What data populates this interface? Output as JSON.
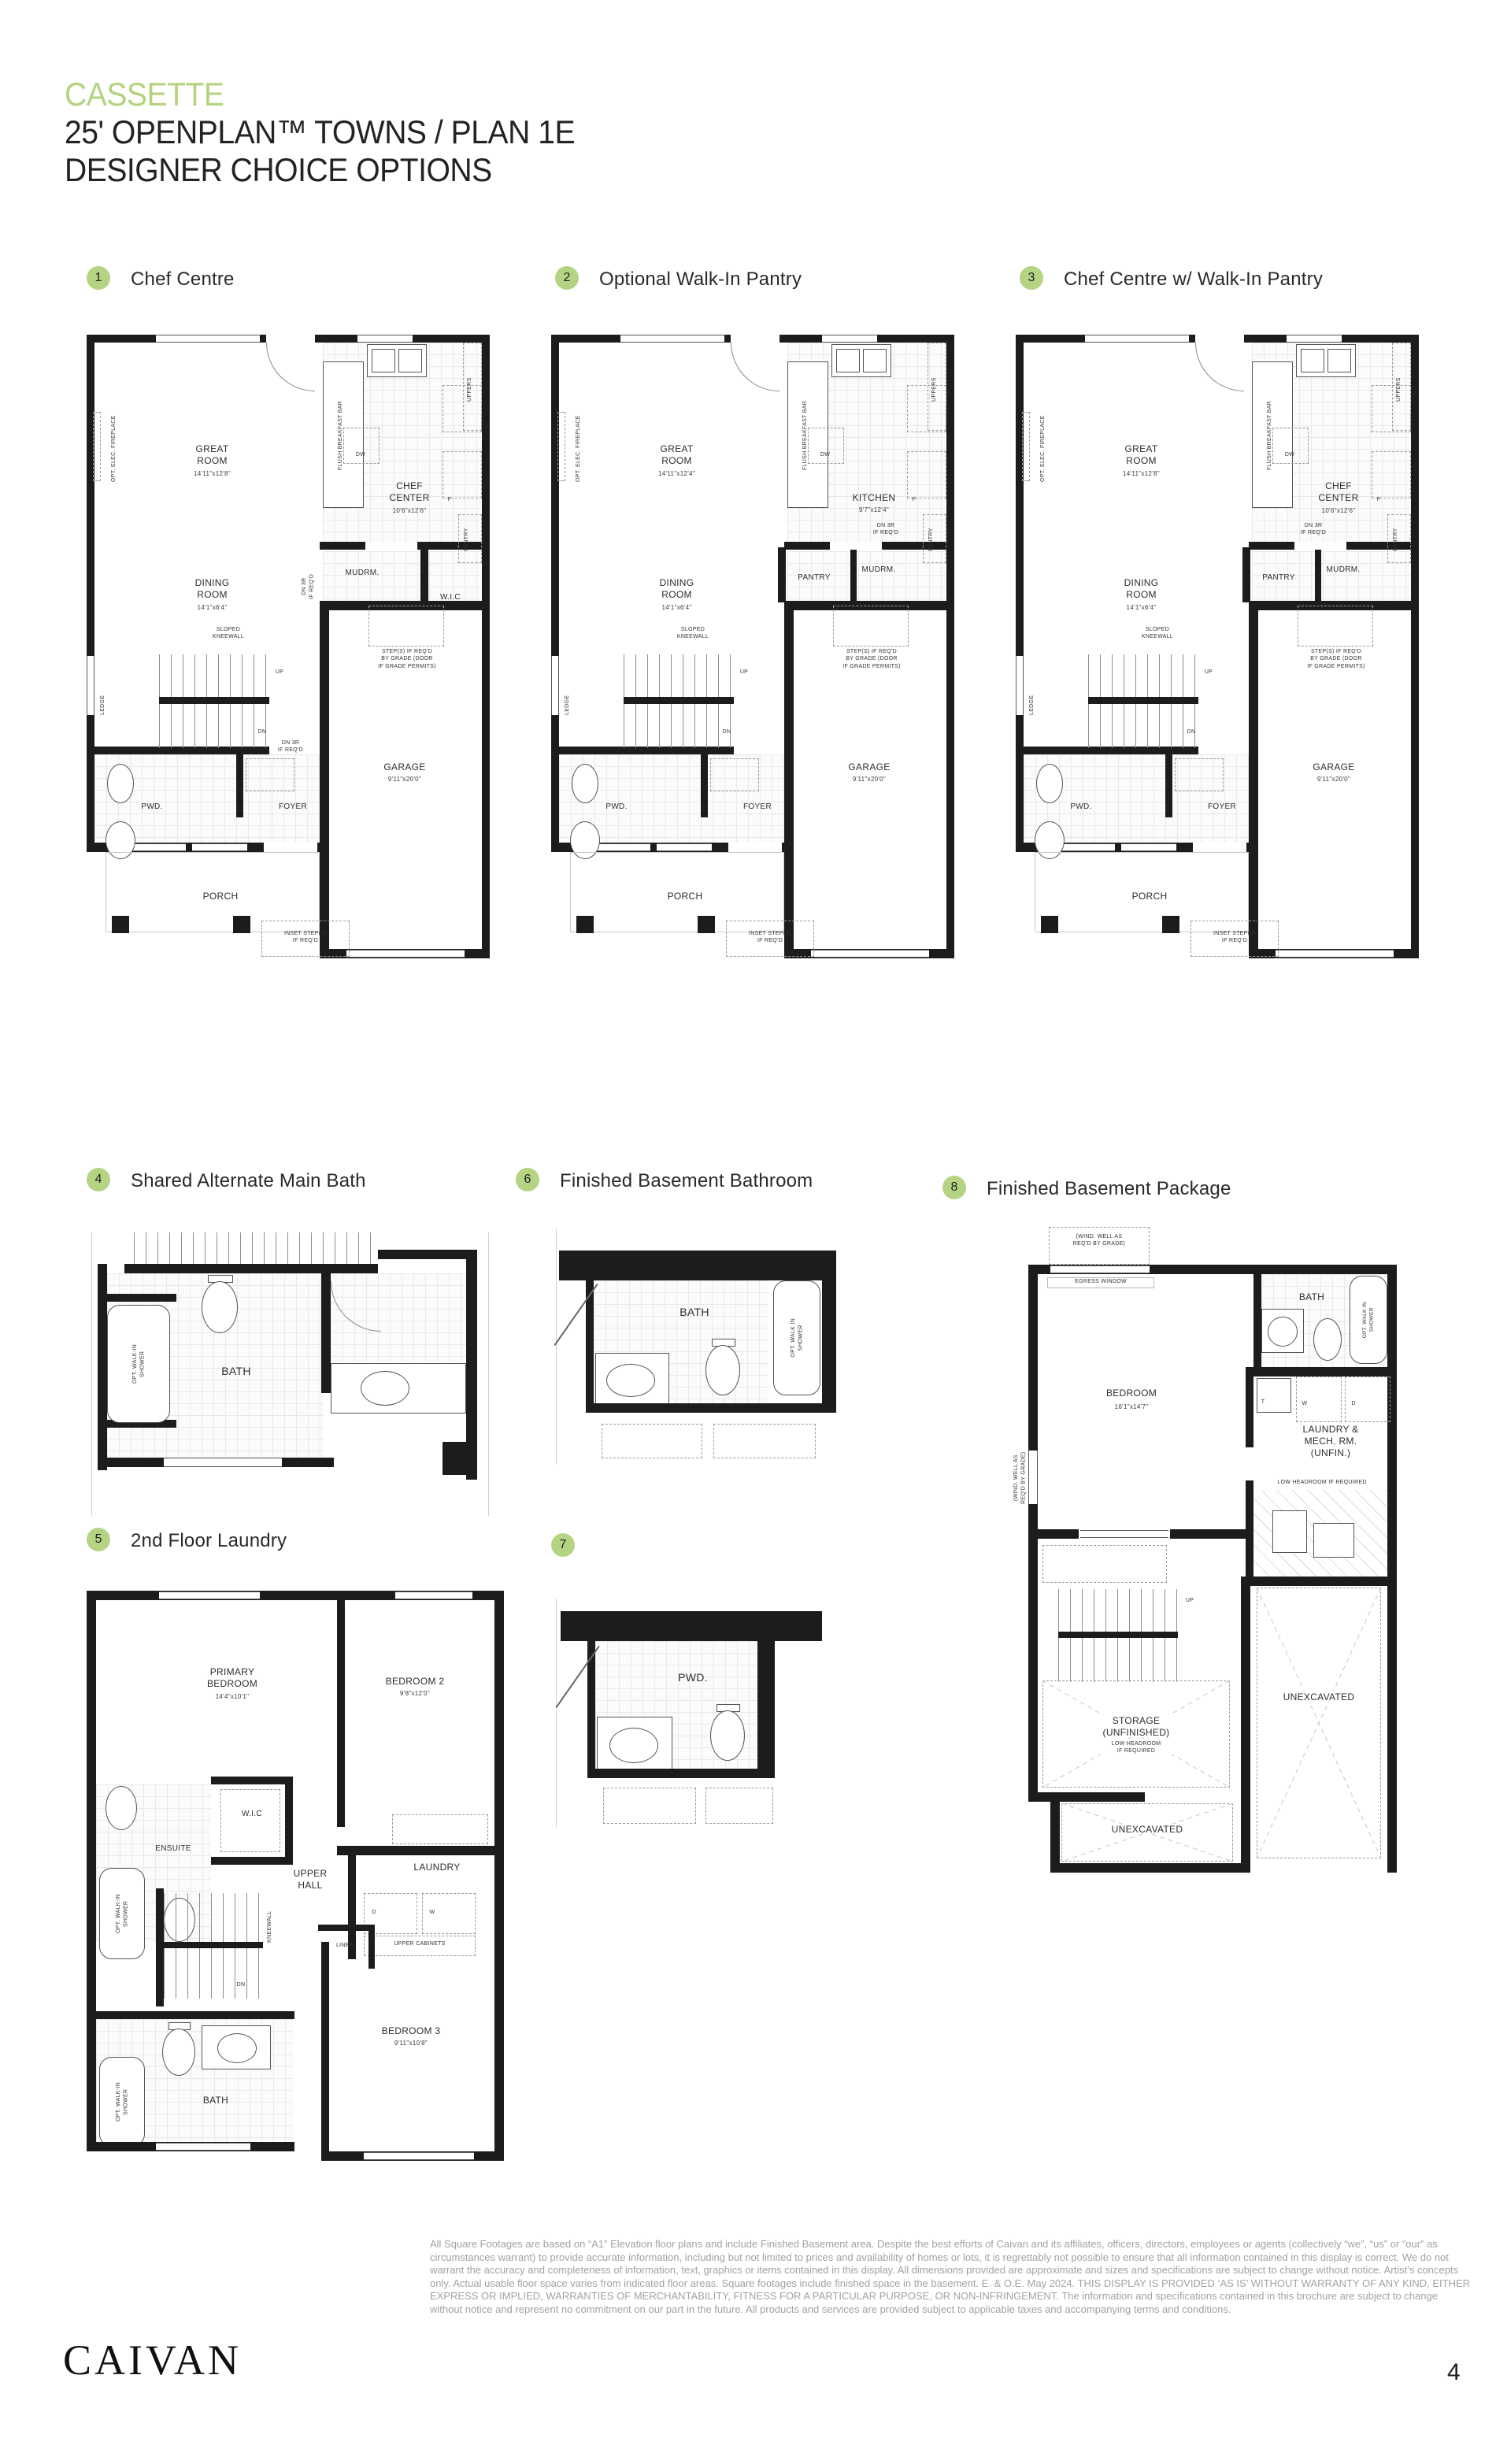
{
  "accent_color": "#b5d483",
  "header": {
    "brand": "CASSETTE",
    "title": "25' OPENPLAN™ TOWNS / PLAN 1E",
    "subtitle": "DESIGNER CHOICE OPTIONS"
  },
  "options": [
    {
      "num": "1",
      "label": "Chef Centre"
    },
    {
      "num": "2",
      "label": "Optional Walk-In Pantry"
    },
    {
      "num": "3",
      "label": "Chef Centre w/ Walk-In Pantry"
    },
    {
      "num": "4",
      "label": "Shared Alternate Main Bath"
    },
    {
      "num": "5",
      "label": "2nd Floor Laundry"
    },
    {
      "num": "6",
      "label": "Finished Basement Bathroom"
    },
    {
      "num": "7",
      "label": ""
    },
    {
      "num": "8",
      "label": "Finished Basement Package"
    }
  ],
  "plan1": {
    "fireplace": "OPT. ELEC. FIREPLACE",
    "great": "GREAT\nROOM",
    "great_dim": "14'11\"x12'8\"",
    "dining": "DINING\nROOM",
    "dining_dim": "14'1\"x6'4\"",
    "chef": "CHEF\nCENTER",
    "chef_dim": "10'6\"x12'6\"",
    "bar": "FLUSH BREAKFAST BAR",
    "uppers": "UPPERS",
    "dw": "DW",
    "f": "F",
    "pantry_cab": "PANTRY",
    "mudrm": "MUDRM.",
    "wic": "W.I.C",
    "dn3r_side": "DN 3R\nIF REQ'D",
    "dn3r": "DN 3R\nIF REQ'D",
    "kneewall": "SLOPED\nKNEEWALL",
    "ledge": "LEDGE",
    "up": "UP",
    "dn": "DN",
    "steps": "STEP(S) IF REQ'D\nBY GRADE (DOOR\nIF GRADE PERMITS)",
    "pwd": "PWD.",
    "foyer": "FOYER",
    "garage": "GARAGE",
    "garage_dim": "9'11\"x20'0\"",
    "porch": "PORCH",
    "inset": "INSET STEP(S)\nIF REQ'D"
  },
  "plan2": {
    "fireplace": "OPT. ELEC. FIREPLACE",
    "great": "GREAT\nROOM",
    "great_dim": "14'11\"x12'4\"",
    "dining": "DINING\nROOM",
    "dining_dim": "14'1\"x6'4\"",
    "kitchen": "KITCHEN",
    "kitchen_dim": "9'7\"x12'4\"",
    "bar": "FLUSH BREAKFAST BAR",
    "uppers": "UPPERS",
    "dw": "DW",
    "f": "F",
    "pantry_cab": "PANTRY",
    "pantry": "PANTRY",
    "mudrm": "MUDRM.",
    "dn3r": "DN 3R\nIF REQ'D",
    "kneewall": "SLOPED\nKNEEWALL",
    "ledge": "LEDGE",
    "up": "UP",
    "dn": "DN",
    "steps": "STEP(S) IF REQ'D\nBY GRADE (DOOR\nIF GRADE PERMITS)",
    "pwd": "PWD.",
    "foyer": "FOYER",
    "garage": "GARAGE",
    "garage_dim": "9'11\"x20'0\"",
    "porch": "PORCH",
    "inset": "INSET STEP(S)\nIF REQ'D"
  },
  "plan3": {
    "fireplace": "OPT. ELEC. FIREPLACE",
    "great": "GREAT\nROOM",
    "great_dim": "14'11\"x12'8\"",
    "dining": "DINING\nROOM",
    "dining_dim": "14'1\"x6'4\"",
    "chef": "CHEF\nCENTER",
    "chef_dim": "10'6\"x12'6\"",
    "bar": "FLUSH BREAKFAST BAR",
    "uppers": "UPPERS",
    "dw": "DW",
    "f": "F",
    "pantry_cab": "PANTRY",
    "pantry": "PANTRY",
    "mudrm": "MUDRM.",
    "dn3r": "DN 3R\nIF REQ'D",
    "kneewall": "SLOPED\nKNEEWALL",
    "ledge": "LEDGE",
    "up": "UP",
    "dn": "DN",
    "steps": "STEP(S) IF REQ'D\nBY GRADE (DOOR\nIF GRADE PERMITS)",
    "pwd": "PWD.",
    "foyer": "FOYER",
    "garage": "GARAGE",
    "garage_dim": "9'11\"x20'0\"",
    "porch": "PORCH",
    "inset": "INSET STEP(S)\nIF REQ'D"
  },
  "plan4": {
    "bath": "BATH",
    "shower": "OPT. WALK-IN\nSHOWER"
  },
  "plan5": {
    "primary": "PRIMARY\nBEDROOM",
    "primary_dim": "14'4\"x10'1\"",
    "bed2": "BEDROOM 2",
    "bed2_dim": "9'8\"x12'0\"",
    "wic": "W.I.C",
    "ensuite": "ENSUITE",
    "shower1": "OPT. WALK-IN\nSHOWER",
    "hall": "UPPER\nHALL",
    "laundry": "LAUNDRY",
    "linen": "LINEN",
    "cabinets": "UPPER CABINETS",
    "d": "D",
    "w": "W",
    "kneewall": "KNEEWALL",
    "dn": "DN",
    "bed3": "BEDROOM 3",
    "bed3_dim": "9'11\"x10'8\"",
    "bath": "BATH",
    "shower2": "OPT. WALK-IN\nSHOWER"
  },
  "plan6": {
    "bath": "BATH",
    "shower": "OPT. WALK IN\nSHOWER"
  },
  "plan7": {
    "pwd": "PWD."
  },
  "plan8": {
    "windwell": "(WIND. WELL AS\nREQ'D BY GRADE)",
    "windwell_left": "(WIND. WELL AS\nREQ'D BY GRADE)",
    "egress": "EGRESS WINDOW",
    "bath": "BATH",
    "shower": "OPT. WALK IN\nSHOWER",
    "t": "T",
    "w": "W",
    "d": "D",
    "bedroom": "BEDROOM",
    "bedroom_dim": "16'1\"x14'7\"",
    "laundry": "LAUNDRY &\nMECH. RM.\n(UNFIN.)",
    "lowhead": "LOW HEADROOM IF REQUIRED",
    "up": "UP",
    "storage": "STORAGE\n(UNFINISHED)",
    "storage_sub": "LOW HEADROOM\nIF REQUIRED",
    "unex1": "UNEXCAVATED",
    "unex2": "UNEXCAVATED"
  },
  "footer": {
    "disclaimer": "All Square Footages are based on “A1” Elevation floor plans and include Finished Basement area. Despite the best efforts of Caivan and its affiliates, officers, directors, employees or agents (collectively “we”, “us” or “our” as circumstances warrant) to provide accurate information, including but not limited to prices and availability of homes or lots, it is regrettably not possible to ensure that all information contained in this display is correct. We do not warrant the accuracy and completeness of information, text, graphics or items contained in this display. All dimensions provided are approximate and sizes and specifications are subject to change without notice. Artist’s concepts only. Actual usable floor space varies from indicated floor areas. Square footages include finished space in the basement. E. & O.E. May 2024. THIS DISPLAY IS PROVIDED ‘AS IS’ WITHOUT WARRANTY OF ANY KIND, EITHER EXPRESS OR IMPLIED, WARRANTIES OF MERCHANTABILITY, FITNESS FOR A PARTICULAR PURPOSE, OR NON-INFRINGEMENT. The information and specifications contained in this brochure are subject to change without notice and represent no commitment on our part in the future. All products and services are provided subject to applicable taxes and accompanying terms and conditions.",
    "logo": "CAIVAN",
    "page": "4"
  }
}
